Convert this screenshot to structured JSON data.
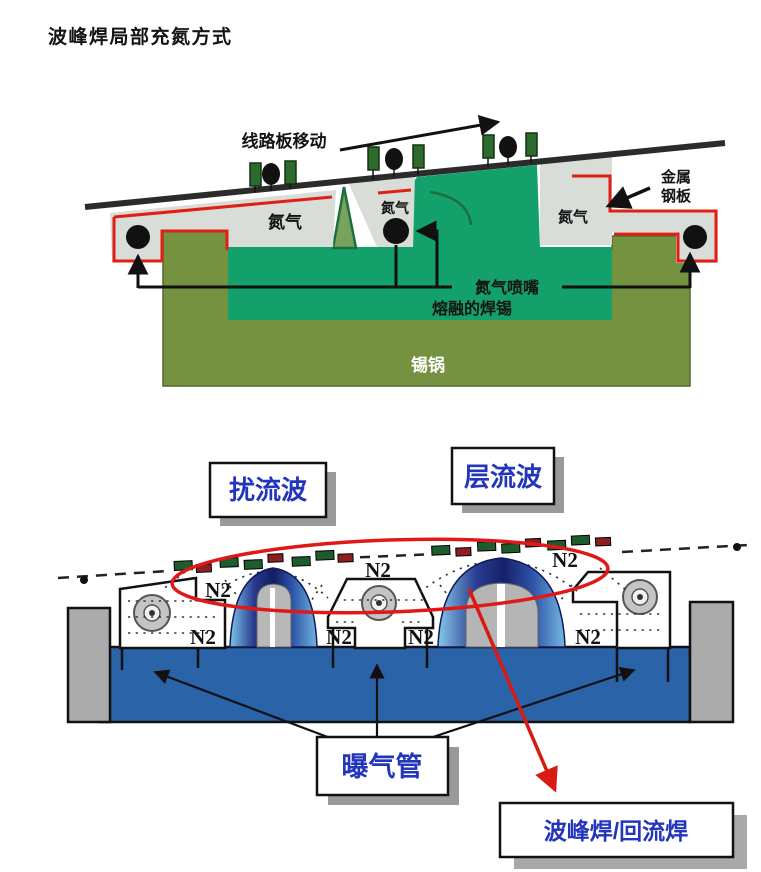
{
  "title": "波峰焊局部充氮方式",
  "colors": {
    "accent_red": "#e02015",
    "steel_gray": "#d8ddd8",
    "pot_olive": "#74923f",
    "solder_teal": "#14a06a",
    "pool_blue": "#2a63a8",
    "label_blue": "#2336bb",
    "wave_navy": "#1b2a78",
    "wave_light_blue": "#7cc4e8"
  },
  "top": {
    "move_label": "线路板移动",
    "n2_left": "氮气",
    "n2_center": "氮气",
    "n2_right": "氮气",
    "metal_plate": [
      "金属",
      "钢板"
    ],
    "nozzle_label": "氮气喷嘴",
    "molten_label": "熔融的焊锡",
    "pot_label": "锡锅"
  },
  "bottom": {
    "turbulent": "扰流波",
    "laminar": "层流波",
    "aeration": "曝气管",
    "combo": "波峰焊/回流焊",
    "n2": [
      "N2",
      "N2",
      "N2",
      "N2",
      "N2",
      "N2",
      "N2"
    ]
  }
}
